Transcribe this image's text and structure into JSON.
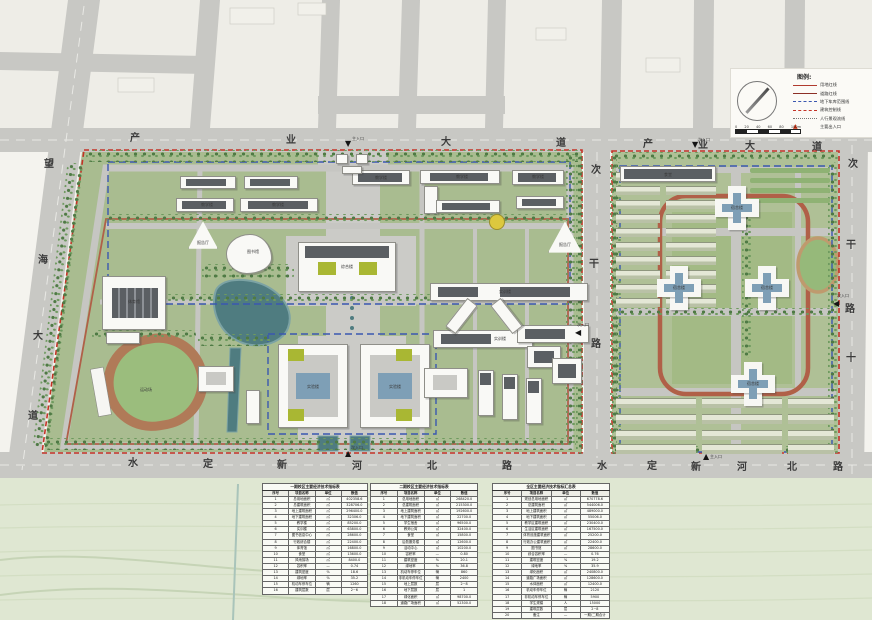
{
  "page": {
    "title": "校园总平面规划图"
  },
  "legend": {
    "title": "图例:",
    "items": [
      {
        "type": "solid-red",
        "label": "用地红线"
      },
      {
        "type": "solid-darkred",
        "label": "道路红线"
      },
      {
        "type": "dash-blue",
        "label": "地下车库范围线"
      },
      {
        "type": "dash-red",
        "label": "建筑控制线"
      },
      {
        "type": "dot-gray",
        "label": "人行景观流线"
      },
      {
        "type": "tri-red",
        "label": "主要出入口"
      }
    ],
    "scale_ticks": [
      "0",
      "20",
      "40",
      "60",
      "80",
      "100m"
    ]
  },
  "road_labels": [
    {
      "t": "产",
      "x": 130,
      "y": 134
    },
    {
      "t": "业",
      "x": 286,
      "y": 136
    },
    {
      "t": "大",
      "x": 441,
      "y": 138
    },
    {
      "t": "道",
      "x": 556,
      "y": 139
    },
    {
      "t": "产",
      "x": 643,
      "y": 140
    },
    {
      "t": "业",
      "x": 698,
      "y": 141
    },
    {
      "t": "大",
      "x": 745,
      "y": 142
    },
    {
      "t": "道",
      "x": 812,
      "y": 143
    },
    {
      "t": "水",
      "x": 128,
      "y": 459
    },
    {
      "t": "定",
      "x": 203,
      "y": 460
    },
    {
      "t": "新",
      "x": 277,
      "y": 461
    },
    {
      "t": "河",
      "x": 352,
      "y": 462
    },
    {
      "t": "北",
      "x": 427,
      "y": 462
    },
    {
      "t": "路",
      "x": 502,
      "y": 462
    },
    {
      "t": "水",
      "x": 597,
      "y": 462
    },
    {
      "t": "定",
      "x": 647,
      "y": 462
    },
    {
      "t": "新",
      "x": 691,
      "y": 463
    },
    {
      "t": "河",
      "x": 737,
      "y": 463
    },
    {
      "t": "北",
      "x": 787,
      "y": 463
    },
    {
      "t": "路",
      "x": 833,
      "y": 463
    },
    {
      "t": "望",
      "x": 44,
      "y": 160
    },
    {
      "t": "海",
      "x": 38,
      "y": 256
    },
    {
      "t": "大",
      "x": 33,
      "y": 332
    },
    {
      "t": "道",
      "x": 28,
      "y": 412
    },
    {
      "t": "次",
      "x": 591,
      "y": 166
    },
    {
      "t": "干",
      "x": 589,
      "y": 260
    },
    {
      "t": "路",
      "x": 591,
      "y": 340
    },
    {
      "t": "次",
      "x": 848,
      "y": 160
    },
    {
      "t": "干",
      "x": 846,
      "y": 241
    },
    {
      "t": "路",
      "x": 845,
      "y": 305
    },
    {
      "t": "十",
      "x": 846,
      "y": 354
    }
  ],
  "markers": [
    {
      "t": "▼",
      "x": 345,
      "y": 140
    },
    {
      "t": "▼",
      "x": 692,
      "y": 141
    },
    {
      "t": "◀",
      "x": 575,
      "y": 329
    },
    {
      "t": "◀",
      "x": 833,
      "y": 300
    },
    {
      "t": "▲",
      "x": 703,
      "y": 453
    },
    {
      "t": "▲",
      "x": 345,
      "y": 450
    }
  ],
  "buildings": [
    [
      180,
      176,
      56,
      13,
      "bld"
    ],
    [
      186,
      179,
      40,
      7,
      "roof"
    ],
    [
      244,
      176,
      54,
      13,
      "bld"
    ],
    [
      250,
      179,
      40,
      7,
      "roof"
    ],
    [
      176,
      198,
      58,
      14,
      "bld"
    ],
    [
      182,
      201,
      44,
      8,
      "roof"
    ],
    [
      240,
      198,
      78,
      14,
      "bld"
    ],
    [
      248,
      201,
      60,
      8,
      "roof"
    ],
    [
      352,
      170,
      58,
      15,
      "bld"
    ],
    [
      358,
      173,
      44,
      9,
      "roof"
    ],
    [
      420,
      170,
      80,
      14,
      "bld"
    ],
    [
      430,
      173,
      58,
      8,
      "roof"
    ],
    [
      424,
      186,
      14,
      28,
      "bld"
    ],
    [
      436,
      200,
      64,
      13,
      "bld"
    ],
    [
      442,
      203,
      48,
      7,
      "roof"
    ],
    [
      512,
      170,
      52,
      15,
      "bld"
    ],
    [
      518,
      173,
      38,
      9,
      "roof"
    ],
    [
      516,
      196,
      48,
      13,
      "bld"
    ],
    [
      522,
      199,
      34,
      7,
      "roof"
    ],
    [
      188,
      220,
      30,
      30,
      "bld tri"
    ],
    [
      548,
      220,
      34,
      34,
      "bld tri"
    ],
    [
      489,
      214,
      16,
      16,
      "ycircle"
    ],
    [
      226,
      234,
      46,
      40,
      "bld blob"
    ],
    [
      336,
      154,
      12,
      10,
      "bld"
    ],
    [
      356,
      154,
      12,
      10,
      "bld"
    ],
    [
      342,
      166,
      20,
      8,
      "bld"
    ],
    [
      298,
      242,
      98,
      50,
      "bld"
    ],
    [
      305,
      246,
      84,
      12,
      "roof"
    ],
    [
      318,
      262,
      18,
      13,
      "groof"
    ],
    [
      359,
      262,
      18,
      13,
      "groof"
    ],
    [
      278,
      344,
      70,
      84,
      "bld"
    ],
    [
      288,
      355,
      50,
      62,
      "court"
    ],
    [
      296,
      373,
      34,
      26,
      "blueglass"
    ],
    [
      288,
      349,
      16,
      12,
      "groof"
    ],
    [
      288,
      409,
      16,
      12,
      "groof"
    ],
    [
      360,
      344,
      70,
      84,
      "bld"
    ],
    [
      370,
      355,
      50,
      62,
      "court"
    ],
    [
      378,
      373,
      34,
      26,
      "blueglass"
    ],
    [
      396,
      349,
      16,
      12,
      "groof"
    ],
    [
      396,
      409,
      16,
      12,
      "groof"
    ],
    [
      102,
      276,
      64,
      54,
      "bld"
    ],
    [
      112,
      288,
      46,
      30,
      "stripes"
    ],
    [
      106,
      332,
      34,
      12,
      "bld"
    ],
    [
      430,
      283,
      158,
      18,
      "bld"
    ],
    [
      438,
      287,
      40,
      10,
      "roof"
    ],
    [
      500,
      287,
      70,
      10,
      "roof"
    ],
    [
      433,
      330,
      100,
      18,
      "bld"
    ],
    [
      441,
      334,
      50,
      10,
      "roof"
    ],
    [
      517,
      325,
      72,
      18,
      "bld"
    ],
    [
      525,
      329,
      40,
      10,
      "roof"
    ],
    [
      455,
      298,
      13,
      36,
      "bld",
      38
    ],
    [
      500,
      298,
      13,
      36,
      "bld",
      -38
    ],
    [
      527,
      346,
      34,
      22,
      "bld"
    ],
    [
      534,
      351,
      20,
      12,
      "roof"
    ],
    [
      424,
      368,
      44,
      30,
      "bld"
    ],
    [
      433,
      375,
      24,
      15,
      "court"
    ],
    [
      478,
      370,
      16,
      46,
      "bld"
    ],
    [
      480,
      373,
      11,
      12,
      "roof"
    ],
    [
      502,
      374,
      16,
      46,
      "bld"
    ],
    [
      504,
      377,
      11,
      12,
      "roof"
    ],
    [
      526,
      378,
      16,
      46,
      "bld"
    ],
    [
      528,
      381,
      11,
      12,
      "roof"
    ],
    [
      552,
      358,
      30,
      26,
      "bld"
    ],
    [
      558,
      364,
      18,
      14,
      "roof"
    ],
    [
      198,
      366,
      36,
      26,
      "bld"
    ],
    [
      206,
      372,
      20,
      13,
      "court"
    ],
    [
      246,
      390,
      14,
      34,
      "bld"
    ],
    [
      620,
      166,
      96,
      16,
      "bld"
    ],
    [
      624,
      169,
      88,
      10,
      "roof"
    ]
  ],
  "towers": [
    [
      715,
      186
    ],
    [
      657,
      266
    ],
    [
      745,
      266
    ],
    [
      731,
      362
    ]
  ],
  "trees": [
    [
      86,
      150,
      496,
      12
    ],
    [
      44,
      438,
      532,
      12
    ],
    [
      566,
      154,
      13,
      290
    ],
    [
      50,
      162,
      16,
      286,
      7
    ],
    [
      106,
      214,
      460,
      8
    ],
    [
      106,
      294,
      460,
      7
    ],
    [
      202,
      264,
      92,
      16
    ],
    [
      198,
      334,
      72,
      12
    ],
    [
      92,
      330,
      104,
      10
    ],
    [
      612,
      152,
      226,
      10
    ],
    [
      612,
      446,
      226,
      10
    ],
    [
      612,
      162,
      10,
      288
    ],
    [
      828,
      162,
      10,
      288
    ],
    [
      618,
      308,
      214,
      7
    ],
    [
      576,
      154,
      7,
      300
    ],
    [
      610,
      154,
      7,
      300
    ],
    [
      742,
      214,
      9,
      144
    ]
  ],
  "strips": [
    [
      616,
      172,
      44,
      8,
      "strip"
    ],
    [
      666,
      172,
      50,
      8,
      "strip"
    ],
    [
      616,
      186,
      44,
      8,
      "strip"
    ],
    [
      666,
      186,
      50,
      8,
      "strip"
    ],
    [
      616,
      200,
      44,
      8,
      "strip"
    ],
    [
      666,
      200,
      50,
      8,
      "strip"
    ],
    [
      616,
      214,
      44,
      8,
      "strip"
    ],
    [
      666,
      214,
      50,
      8,
      "strip"
    ],
    [
      616,
      228,
      44,
      8,
      "strip"
    ],
    [
      666,
      228,
      50,
      8,
      "strip"
    ],
    [
      616,
      242,
      44,
      8,
      "strip"
    ],
    [
      666,
      242,
      50,
      8,
      "strip"
    ],
    [
      616,
      256,
      44,
      8,
      "strip"
    ],
    [
      666,
      256,
      50,
      8,
      "strip"
    ],
    [
      616,
      270,
      44,
      8,
      "strip"
    ],
    [
      666,
      270,
      50,
      8,
      "strip"
    ],
    [
      616,
      284,
      44,
      8,
      "strip"
    ],
    [
      666,
      284,
      50,
      8,
      "strip"
    ],
    [
      616,
      298,
      44,
      8,
      "strip"
    ],
    [
      666,
      298,
      50,
      8,
      "strip"
    ],
    [
      750,
      168,
      80,
      5,
      "hedge"
    ],
    [
      750,
      178,
      80,
      5,
      "hedge"
    ],
    [
      750,
      188,
      80,
      5,
      "hedge"
    ],
    [
      750,
      198,
      80,
      5,
      "hedge"
    ],
    [
      616,
      398,
      80,
      9,
      "strip"
    ],
    [
      702,
      398,
      80,
      9,
      "strip"
    ],
    [
      788,
      398,
      46,
      9,
      "strip"
    ],
    [
      616,
      414,
      80,
      9,
      "strip"
    ],
    [
      702,
      414,
      80,
      9,
      "strip"
    ],
    [
      788,
      414,
      46,
      9,
      "strip"
    ],
    [
      616,
      430,
      80,
      9,
      "strip"
    ],
    [
      702,
      430,
      80,
      9,
      "strip"
    ],
    [
      788,
      430,
      46,
      9,
      "strip"
    ],
    [
      616,
      444,
      80,
      9,
      "strip"
    ],
    [
      702,
      444,
      80,
      9,
      "strip"
    ],
    [
      788,
      444,
      46,
      9,
      "strip"
    ]
  ],
  "tiny_labels": [
    {
      "t": "综合楼",
      "x": 347,
      "y": 267
    },
    {
      "t": "实验楼",
      "x": 313,
      "y": 387
    },
    {
      "t": "实验楼",
      "x": 395,
      "y": 387
    },
    {
      "t": "体育馆",
      "x": 134,
      "y": 302
    },
    {
      "t": "运动场",
      "x": 146,
      "y": 390
    },
    {
      "t": "实训楼",
      "x": 505,
      "y": 292
    },
    {
      "t": "实训楼",
      "x": 500,
      "y": 339
    },
    {
      "t": "教学楼",
      "x": 207,
      "y": 205
    },
    {
      "t": "教学楼",
      "x": 278,
      "y": 205
    },
    {
      "t": "教学楼",
      "x": 381,
      "y": 178
    },
    {
      "t": "教学楼",
      "x": 462,
      "y": 177
    },
    {
      "t": "教学楼",
      "x": 538,
      "y": 177
    },
    {
      "t": "报告厅",
      "x": 203,
      "y": 243
    },
    {
      "t": "报告厅",
      "x": 565,
      "y": 245
    },
    {
      "t": "图书馆",
      "x": 253,
      "y": 252
    },
    {
      "t": "食堂",
      "x": 668,
      "y": 175
    },
    {
      "t": "宿舍楼",
      "x": 737,
      "y": 208
    },
    {
      "t": "宿舍楼",
      "x": 679,
      "y": 288
    },
    {
      "t": "宿舍楼",
      "x": 767,
      "y": 288
    },
    {
      "t": "宿舍楼",
      "x": 753,
      "y": 384
    },
    {
      "t": "主入口",
      "x": 358,
      "y": 139
    },
    {
      "t": "次入口",
      "x": 704,
      "y": 140
    },
    {
      "t": "次入口",
      "x": 583,
      "y": 325
    },
    {
      "t": "次入口",
      "x": 843,
      "y": 296
    },
    {
      "t": "主入口",
      "x": 716,
      "y": 457
    },
    {
      "t": "次入口",
      "x": 357,
      "y": 448
    }
  ],
  "tables": [
    {
      "x": 262,
      "y": 483,
      "w": 106,
      "title": "一期校区主要经济技术指标表",
      "cols": [
        "序号",
        "项目名称",
        "单位",
        "数值"
      ],
      "rows": [
        [
          "1",
          "总用地面积",
          "㎡",
          "402358.6"
        ],
        [
          "2",
          "总建筑面积",
          "㎡",
          "328706.0"
        ],
        [
          "3",
          "地上建筑面积",
          "㎡",
          "296400.0"
        ],
        [
          "4",
          "地下建筑面积",
          "㎡",
          "32306.0"
        ],
        [
          "5",
          "教学楼",
          "㎡",
          "85200.0"
        ],
        [
          "6",
          "实训楼",
          "㎡",
          "63800.0"
        ],
        [
          "7",
          "图书信息中心",
          "㎡",
          "28600.0"
        ],
        [
          "8",
          "行政综合楼",
          "㎡",
          "22400.0"
        ],
        [
          "9",
          "体育馆",
          "㎡",
          "16800.0"
        ],
        [
          "10",
          "食堂",
          "㎡",
          "13600.0"
        ],
        [
          "11",
          "风雨操场",
          "㎡",
          "8400.0"
        ],
        [
          "12",
          "容积率",
          "—",
          "0.74"
        ],
        [
          "13",
          "建筑密度",
          "%",
          "18.6"
        ],
        [
          "14",
          "绿地率",
          "%",
          "35.2"
        ],
        [
          "15",
          "机动车停车位",
          "辆",
          "1260"
        ],
        [
          "16",
          "建筑层数",
          "层",
          "2~6"
        ]
      ]
    },
    {
      "x": 370,
      "y": 483,
      "w": 108,
      "title": "二期校区主要经济技术指标表",
      "cols": [
        "序号",
        "项目名称",
        "单位",
        "数值"
      ],
      "rows": [
        [
          "1",
          "总用地面积",
          "㎡",
          "268420.0"
        ],
        [
          "2",
          "总建筑面积",
          "㎡",
          "215300.0"
        ],
        [
          "3",
          "地上建筑面积",
          "㎡",
          "192600.0"
        ],
        [
          "4",
          "地下建筑面积",
          "㎡",
          "22700.0"
        ],
        [
          "5",
          "学生宿舍",
          "㎡",
          "96500.0"
        ],
        [
          "6",
          "教师公寓",
          "㎡",
          "32400.0"
        ],
        [
          "7",
          "食堂",
          "㎡",
          "15800.0"
        ],
        [
          "8",
          "后勤服务楼",
          "㎡",
          "12600.0"
        ],
        [
          "9",
          "活动中心",
          "㎡",
          "10200.0"
        ],
        [
          "10",
          "容积率",
          "—",
          "0.80"
        ],
        [
          "11",
          "建筑密度",
          "%",
          "20.1"
        ],
        [
          "12",
          "绿地率",
          "%",
          "36.8"
        ],
        [
          "13",
          "机动车停车位",
          "辆",
          "860"
        ],
        [
          "14",
          "非机动车停车位",
          "辆",
          "2400"
        ],
        [
          "15",
          "地上层数",
          "层",
          "2~8"
        ],
        [
          "16",
          "地下层数",
          "层",
          "1"
        ],
        [
          "17",
          "绿化面积",
          "㎡",
          "98700.0"
        ],
        [
          "18",
          "道路广场面积",
          "㎡",
          "52300.0"
        ]
      ]
    },
    {
      "x": 492,
      "y": 483,
      "w": 118,
      "title": "全区主要经济技术指标汇总表",
      "cols": [
        "序号",
        "项目名称",
        "单位",
        "数值"
      ],
      "rows": [
        [
          "1",
          "规划总用地面积",
          "㎡",
          "670778.6"
        ],
        [
          "2",
          "总建筑面积",
          "㎡",
          "544006.0"
        ],
        [
          "3",
          "地上建筑面积",
          "㎡",
          "489000.0"
        ],
        [
          "4",
          "地下建筑面积",
          "㎡",
          "55006.0"
        ],
        [
          "5",
          "教学区建筑面积",
          "㎡",
          "230400.0"
        ],
        [
          "6",
          "生活区建筑面积",
          "㎡",
          "167500.0"
        ],
        [
          "7",
          "体育设施建筑面积",
          "㎡",
          "25200.0"
        ],
        [
          "8",
          "行政办公建筑面积",
          "㎡",
          "22400.0"
        ],
        [
          "9",
          "图书馆",
          "㎡",
          "28600.0"
        ],
        [
          "10",
          "综合容积率",
          "—",
          "0.76"
        ],
        [
          "11",
          "建筑密度",
          "%",
          "19.2"
        ],
        [
          "12",
          "绿地率",
          "%",
          "35.9"
        ],
        [
          "13",
          "绿化面积",
          "㎡",
          "240800.0"
        ],
        [
          "14",
          "道路广场面积",
          "㎡",
          "128600.0"
        ],
        [
          "15",
          "水体面积",
          "㎡",
          "12400.0"
        ],
        [
          "16",
          "机动车停车位",
          "辆",
          "2120"
        ],
        [
          "17",
          "非机动车停车位",
          "辆",
          "5900"
        ],
        [
          "18",
          "学生规模",
          "人",
          "15000"
        ],
        [
          "19",
          "建筑层数",
          "层",
          "2~8"
        ],
        [
          "20",
          "备注",
          "—",
          "一期/二期合计"
        ]
      ]
    }
  ]
}
